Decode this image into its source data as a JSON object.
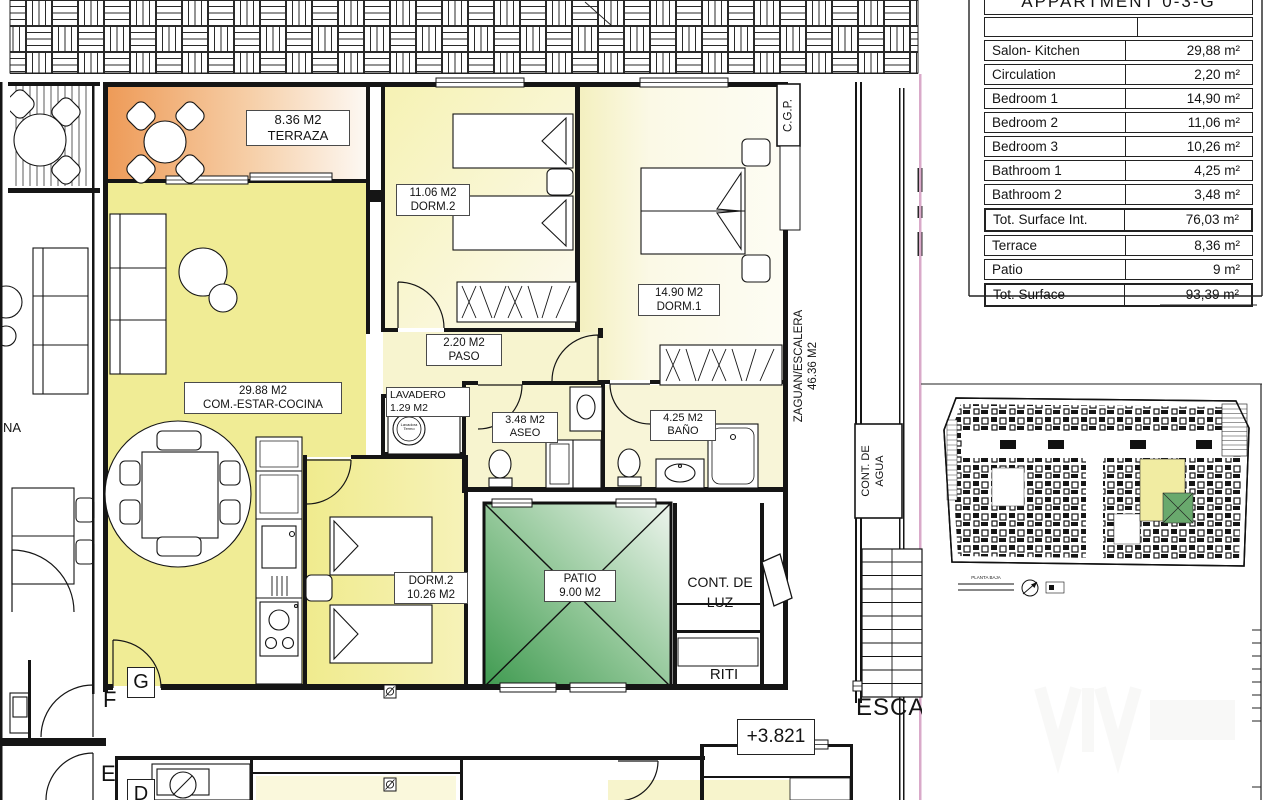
{
  "areas_table": {
    "title": "APPARTMENT 0-3-G",
    "rows": [
      {
        "label": "Salon- Kitchen",
        "value": "29,88 m²"
      },
      {
        "label": "Circulation",
        "value": "2,20 m²"
      },
      {
        "label": "Bedroom 1",
        "value": "14,90 m²"
      },
      {
        "label": "Bedroom 2",
        "value": "11,06 m²"
      },
      {
        "label": "Bedroom 3",
        "value": "10,26 m²"
      },
      {
        "label": "Bathroom 1",
        "value": "4,25 m²"
      },
      {
        "label": "Bathroom 2",
        "value": "3,48 m²"
      },
      {
        "label": "Tot. Surface Int.",
        "value": "76,03 m²"
      },
      {
        "label": "Terrace",
        "value": "8,36 m²"
      },
      {
        "label": "Patio",
        "value": "9 m²"
      },
      {
        "label": "Tot. Surface",
        "value": "93,39 m²"
      }
    ]
  },
  "plan": {
    "rooms": {
      "terraza": {
        "area": "8.36 M2",
        "name": "TERRAZA"
      },
      "dorm2_top": {
        "area": "11.06 M2",
        "name": "DORM.2"
      },
      "dorm1": {
        "area": "14.90 M2",
        "name": "DORM.1"
      },
      "paso": {
        "area": "2.20 M2",
        "name": "PASO"
      },
      "salon": {
        "area": "29.88 M2",
        "name": "COM.-ESTAR-COCINA"
      },
      "lavadero": {
        "name": "LAVADERO",
        "area": "1.29 M2"
      },
      "aseo": {
        "area": "3.48 M2",
        "name": "ASEO"
      },
      "bano": {
        "area": "4.25 M2",
        "name": "BAÑO"
      },
      "dorm3": {
        "name": "DORM.2",
        "area": "10.26 M2"
      },
      "patio": {
        "name": "PATIO",
        "area": "9.00 M2"
      },
      "cont_luz": {
        "line1": "CONT. DE",
        "line2": "LUZ"
      },
      "riti": {
        "name": "RITI"
      },
      "zaguan": {
        "name": "ZAGUAN/ESCALERA",
        "area": "46.36 M2"
      },
      "cont_agua": {
        "line1": "CONT. DE",
        "line2": "AGUA"
      },
      "cgp": {
        "name": "C.G.P."
      }
    },
    "annotations": {
      "level": "+3.821",
      "stair_label": "ESCA",
      "left_fragment": "NA",
      "unit_letters": [
        "G",
        "F",
        "E",
        "D"
      ],
      "washer_line1": "Lavadora",
      "washer_line2": "Termo"
    },
    "keyplan": {
      "caption": "PLANTA BAJA"
    }
  },
  "colors": {
    "apartment_yellow": "#f0ec95",
    "pale_yellow": "#f7f4cf",
    "terrace_orange": "#ee9b58",
    "patio_green": "#3f9a50",
    "boundary_pink": "#d9a9c9",
    "keyplan_highlight": "#f1eca2"
  }
}
